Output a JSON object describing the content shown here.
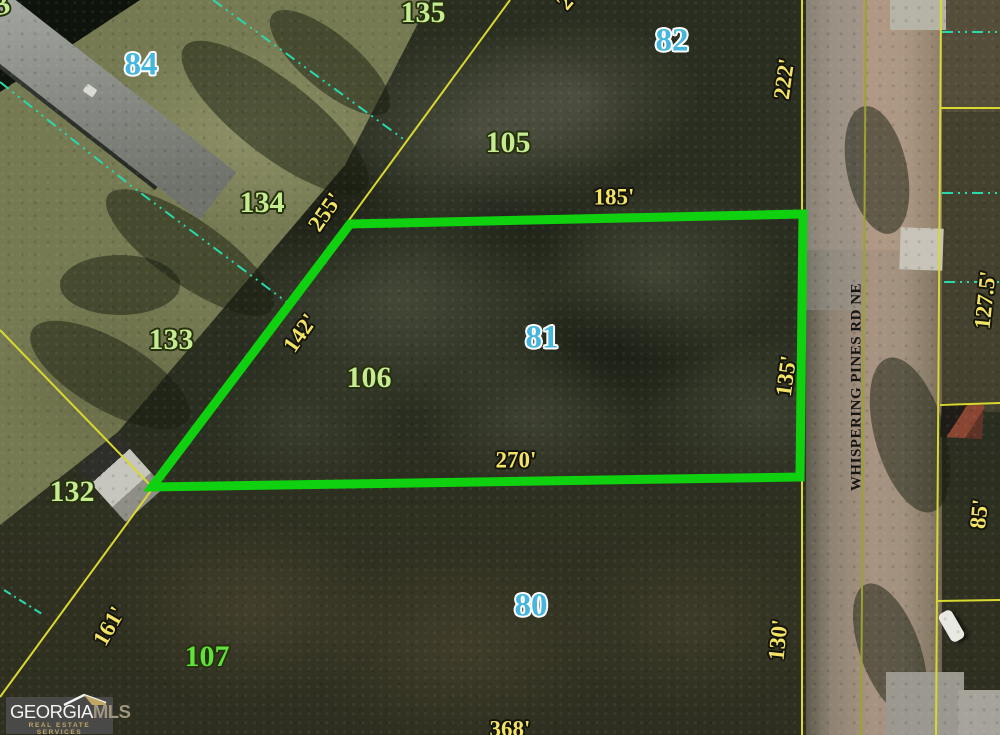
{
  "map": {
    "street": {
      "name": "WHISPERING PINES RD NE"
    },
    "highlighted_parcel": "81",
    "parcel_numbers": [
      {
        "text": "84",
        "style": "cyan"
      },
      {
        "text": "82",
        "style": "cyan"
      },
      {
        "text": "81",
        "style": "cyan"
      },
      {
        "text": "80",
        "style": "cyan"
      },
      {
        "text": "135",
        "style": "green"
      },
      {
        "text": "134",
        "style": "green"
      },
      {
        "text": "105",
        "style": "green"
      },
      {
        "text": "106",
        "style": "green"
      },
      {
        "text": "133",
        "style": "green"
      },
      {
        "text": "132",
        "style": "green"
      },
      {
        "text": "107",
        "style": "bright-green"
      }
    ],
    "dimension_labels": [
      {
        "text": "255'"
      },
      {
        "text": "185'"
      },
      {
        "text": "222'"
      },
      {
        "text": "142'"
      },
      {
        "text": "135'"
      },
      {
        "text": "270'"
      },
      {
        "text": "130'"
      },
      {
        "text": "161'"
      },
      {
        "text": "368'"
      },
      {
        "text": "127.5'"
      },
      {
        "text": "85'"
      }
    ],
    "partial_labels": [
      {
        "text": "2"
      },
      {
        "text": "3"
      }
    ]
  },
  "logo": {
    "brand_primary": "GEORGIA",
    "brand_secondary": "MLS",
    "tagline": "REAL ESTATE SERVICES"
  },
  "colors": {
    "highlight_green": "#0fd10f",
    "parcel_line_yellow": "#d8d832",
    "road_edge_olive": "#9aa32e",
    "utility_dash_cyan": "#2bd8ac",
    "num_cyan": "#45b7de",
    "num_green": "#c6ec92",
    "num_bright_green": "#5fe23a",
    "dim_yellow": "#f2e366",
    "street_text": "#141410",
    "logo_bg": "#4b4b4b",
    "logo_gold": "#c9ad6a"
  }
}
